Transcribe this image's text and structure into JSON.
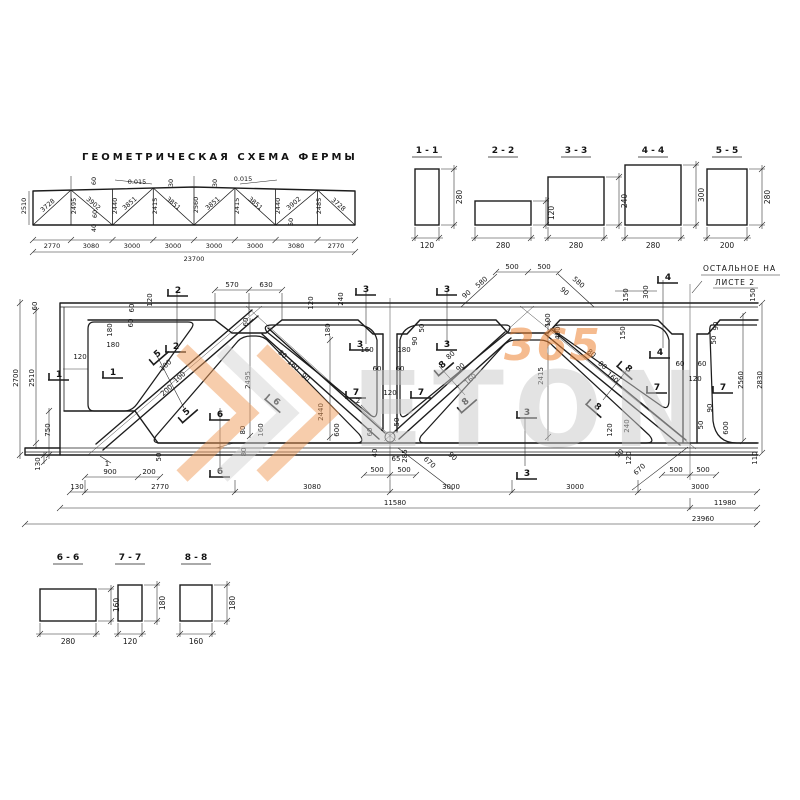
{
  "scheme": {
    "title": "ГЕОМЕТРИЧЕСКАЯ  СХЕМА  ФЕРМЫ",
    "labels": [
      [
        26,
        206,
        "2510",
        -90
      ],
      [
        49,
        207,
        "3728",
        -41
      ],
      [
        76,
        206,
        "2495",
        -90
      ],
      [
        92,
        205,
        "3902",
        41
      ],
      [
        117,
        206,
        "2440",
        -90
      ],
      [
        131,
        205,
        "3851",
        -41
      ],
      [
        157,
        206,
        "2415",
        -90
      ],
      [
        172,
        205,
        "3851",
        41
      ],
      [
        198,
        205,
        "2560",
        -90
      ],
      [
        214,
        205,
        "3851",
        -41
      ],
      [
        239,
        206,
        "2415",
        -90
      ],
      [
        254,
        205,
        "3851",
        41
      ],
      [
        280,
        206,
        "2440",
        -90
      ],
      [
        295,
        205,
        "3902",
        -41
      ],
      [
        321,
        206,
        "2485",
        -90
      ],
      [
        337,
        206,
        "3728",
        41
      ],
      [
        96,
        181,
        "60",
        -90
      ],
      [
        97,
        214,
        "60",
        -90
      ],
      [
        96,
        228,
        "40",
        -90
      ],
      [
        137,
        184,
        "0.015",
        0
      ],
      [
        173,
        183,
        "30",
        -90
      ],
      [
        217,
        183,
        "30",
        -90
      ],
      [
        243,
        181,
        "0.015",
        0
      ],
      [
        293,
        222,
        "50",
        -90
      ],
      [
        52,
        248,
        "2770",
        0
      ],
      [
        91,
        248,
        "3080",
        0
      ],
      [
        132,
        248,
        "3000",
        0
      ],
      [
        173,
        248,
        "3000",
        0
      ],
      [
        214,
        248,
        "3000",
        0
      ],
      [
        255,
        248,
        "3000",
        0
      ],
      [
        296,
        248,
        "3080",
        0
      ],
      [
        336,
        248,
        "2770",
        0
      ],
      [
        194,
        261,
        "23700",
        0
      ]
    ]
  },
  "sections_top": [
    {
      "label": "1 - 1",
      "w": "120",
      "h": "280"
    },
    {
      "label": "2 - 2",
      "w": "280",
      "h": "120"
    },
    {
      "label": "3 - 3",
      "w": "280",
      "h": "240"
    },
    {
      "label": "4 - 4",
      "w": "280",
      "h": "300"
    },
    {
      "label": "5 - 5",
      "w": "200",
      "h": "280"
    }
  ],
  "sections_bottom": [
    {
      "label": "6 - 6",
      "w": "280",
      "h": "160"
    },
    {
      "label": "7 - 7",
      "w": "120",
      "h": "180"
    },
    {
      "label": "8 - 8",
      "w": "160",
      "h": "180"
    }
  ],
  "main": {
    "note1": "ОСТАЛЬНОЕ  НА",
    "note2": "ЛИСТЕ  2",
    "labels": [
      [
        18,
        378,
        "2700",
        -90
      ],
      [
        34,
        378,
        "2510",
        -90
      ],
      [
        37,
        306,
        "60",
        -90
      ],
      [
        50,
        430,
        "750",
        -90
      ],
      [
        40,
        464,
        "130",
        -90
      ],
      [
        134,
        308,
        "60",
        -90
      ],
      [
        152,
        300,
        "120",
        -90
      ],
      [
        133,
        323,
        "60",
        -90
      ],
      [
        112,
        330,
        "180",
        -90
      ],
      [
        113,
        347,
        "180",
        0
      ],
      [
        80,
        359,
        "120",
        0
      ],
      [
        161,
        457,
        "50",
        -90
      ],
      [
        110,
        474,
        "900",
        0
      ],
      [
        149,
        474,
        "200",
        0
      ],
      [
        245,
        430,
        "80",
        -90
      ],
      [
        263,
        430,
        "160",
        -90
      ],
      [
        246,
        452,
        "80",
        -90
      ],
      [
        232,
        287,
        "570",
        0
      ],
      [
        266,
        287,
        "630",
        0
      ],
      [
        248,
        322,
        "60",
        -90
      ],
      [
        167,
        367,
        "100",
        -41
      ],
      [
        181,
        379,
        "100",
        -41
      ],
      [
        168,
        392,
        "200",
        -41
      ],
      [
        250,
        380,
        "2495",
        -90
      ],
      [
        281,
        356,
        "80",
        41
      ],
      [
        292,
        367,
        "160",
        41
      ],
      [
        304,
        379,
        "90",
        41
      ],
      [
        323,
        412,
        "2440",
        -90
      ],
      [
        339,
        430,
        "600",
        -90
      ],
      [
        313,
        303,
        "120",
        -90
      ],
      [
        343,
        299,
        "240",
        -90
      ],
      [
        330,
        330,
        "180",
        -90
      ],
      [
        367,
        352,
        "160",
        0
      ],
      [
        404,
        352,
        "180",
        0
      ],
      [
        417,
        341,
        "90",
        -90
      ],
      [
        424,
        328,
        "50",
        -90
      ],
      [
        377,
        371,
        "60",
        0
      ],
      [
        400,
        371,
        "60",
        0
      ],
      [
        390,
        395,
        "120",
        0
      ],
      [
        372,
        432,
        "60",
        -90
      ],
      [
        377,
        453,
        "40",
        -90
      ],
      [
        399,
        422,
        "50",
        -90
      ],
      [
        396,
        461,
        "65",
        0
      ],
      [
        407,
        456,
        "285",
        -90
      ],
      [
        428,
        464,
        "670",
        43
      ],
      [
        451,
        458,
        "90",
        43
      ],
      [
        377,
        472,
        "500",
        0
      ],
      [
        404,
        472,
        "500",
        0
      ],
      [
        358,
        403,
        "2",
        0
      ],
      [
        107,
        466,
        "1",
        0
      ],
      [
        452,
        357,
        "80",
        -41
      ],
      [
        462,
        369,
        "90",
        -41
      ],
      [
        472,
        381,
        "160",
        -41
      ],
      [
        512,
        269,
        "500",
        0
      ],
      [
        544,
        269,
        "500",
        0
      ],
      [
        483,
        284,
        "580",
        -41
      ],
      [
        577,
        284,
        "580",
        41
      ],
      [
        468,
        296,
        "90",
        -41
      ],
      [
        563,
        293,
        "90",
        41
      ],
      [
        550,
        320,
        "100",
        -90
      ],
      [
        560,
        333,
        "400",
        -90
      ],
      [
        543,
        376,
        "2415",
        -90
      ],
      [
        590,
        355,
        "80",
        41
      ],
      [
        601,
        367,
        "80",
        41
      ],
      [
        611,
        379,
        "160",
        41
      ],
      [
        628,
        295,
        "150",
        -90
      ],
      [
        648,
        292,
        "300",
        -90
      ],
      [
        625,
        333,
        "150",
        -90
      ],
      [
        612,
        430,
        "120",
        -90
      ],
      [
        629,
        426,
        "240",
        -90
      ],
      [
        631,
        458,
        "120",
        -90
      ],
      [
        621,
        455,
        "90",
        -43
      ],
      [
        641,
        471,
        "670",
        -43
      ],
      [
        676,
        472,
        "500",
        0
      ],
      [
        703,
        472,
        "500",
        0
      ],
      [
        680,
        366,
        "60",
        0
      ],
      [
        702,
        366,
        "60",
        0
      ],
      [
        695,
        381,
        "120",
        0
      ],
      [
        718,
        326,
        "90",
        -90
      ],
      [
        716,
        340,
        "50",
        -90
      ],
      [
        712,
        408,
        "90",
        -90
      ],
      [
        703,
        425,
        "50",
        -90
      ],
      [
        728,
        428,
        "600",
        -90
      ],
      [
        743,
        380,
        "2560",
        -90
      ],
      [
        762,
        380,
        "2830",
        -90
      ],
      [
        755,
        295,
        "150",
        -90
      ],
      [
        757,
        458,
        "110",
        -90
      ],
      [
        77,
        489,
        "130",
        0
      ],
      [
        160,
        489,
        "2770",
        0
      ],
      [
        312,
        489,
        "3080",
        0
      ],
      [
        451,
        489,
        "3000",
        0
      ],
      [
        575,
        489,
        "3000",
        0
      ],
      [
        700,
        489,
        "3000",
        0
      ],
      [
        395,
        505,
        "11580",
        0
      ],
      [
        725,
        505,
        "11980",
        0
      ],
      [
        703,
        521,
        "23960",
        0
      ]
    ],
    "marks": [
      [
        59,
        372,
        "1",
        0
      ],
      [
        113,
        370,
        "1",
        0
      ],
      [
        178,
        288,
        "2",
        0
      ],
      [
        176,
        344,
        "2",
        0
      ],
      [
        366,
        287,
        "3",
        0
      ],
      [
        447,
        287,
        "3",
        0
      ],
      [
        360,
        342,
        "3",
        0
      ],
      [
        447,
        342,
        "3",
        0
      ],
      [
        527,
        410,
        "3",
        0
      ],
      [
        527,
        471,
        "3",
        0
      ],
      [
        668,
        275,
        "4",
        0
      ],
      [
        660,
        350,
        "4",
        0
      ],
      [
        156,
        352,
        "5",
        -41
      ],
      [
        185,
        410,
        "5",
        -41
      ],
      [
        220,
        412,
        "6",
        0
      ],
      [
        220,
        469,
        "6",
        0
      ],
      [
        278,
        400,
        "6",
        41
      ],
      [
        356,
        390,
        "7",
        0
      ],
      [
        421,
        390,
        "7",
        0
      ],
      [
        657,
        385,
        "7",
        0
      ],
      [
        723,
        385,
        "7",
        0
      ],
      [
        441,
        363,
        "8",
        -41
      ],
      [
        464,
        400,
        "8",
        -41
      ],
      [
        599,
        405,
        "8",
        41
      ],
      [
        630,
        367,
        "8",
        41
      ]
    ]
  },
  "watermark": {
    "text": "ETON",
    "number": "365",
    "orange": "#ee8435",
    "gray": "#c9c9c9"
  }
}
